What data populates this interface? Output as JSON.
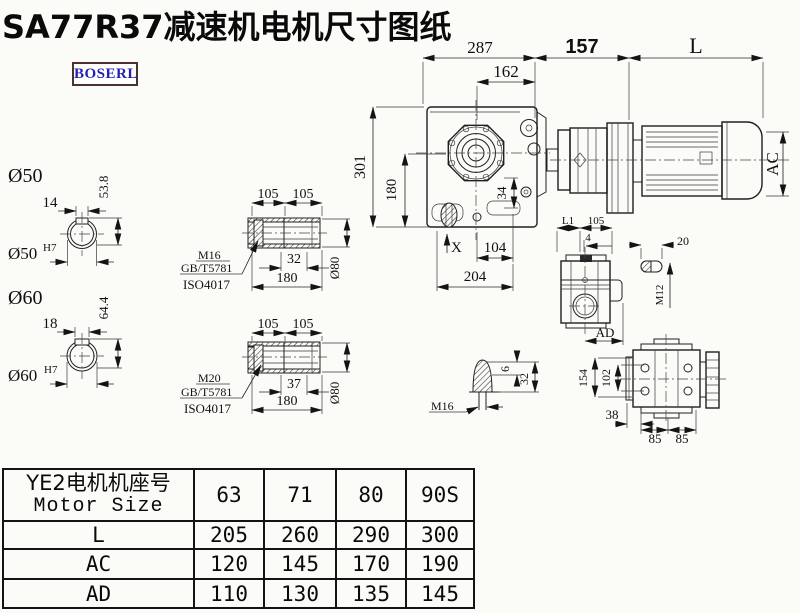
{
  "page": {
    "title": "SA77R37减速机电机尺寸图纸",
    "brand": "BOSERL"
  },
  "colors": {
    "background": "#fbfbf8",
    "line": "#1f1f1f",
    "brand_text": "#241fb0",
    "brand_border": "#4a3232",
    "table_border": "#141414"
  },
  "main_view": {
    "top_width": "287",
    "flange_width": "162",
    "adapter_length": "157",
    "motor_length": "L",
    "total_height": "301",
    "lower_height": "180",
    "motor_diameter": "AC",
    "offset_34": "34",
    "mark_x": "X",
    "bottom_offset": "104",
    "bottom_width": "204"
  },
  "shaft_detail_50": {
    "label": "Ø50",
    "keyway_width": "14",
    "keyway_depth": "53.8",
    "bore": "Ø50",
    "bore_tol": "H7"
  },
  "shaft_detail_60": {
    "label": "Ø60",
    "keyway_width": "18",
    "keyway_depth": "64.4",
    "bore": "Ø60",
    "bore_tol": "H7"
  },
  "hollow_shaft_1": {
    "len_a": "105",
    "len_b": "105",
    "screw_len": "32",
    "total_len": "180",
    "outer_dia": "Ø80",
    "thread": "M16",
    "standard_1": "GB/T5781",
    "standard_2": "ISO4017"
  },
  "hollow_shaft_2": {
    "len_a": "105",
    "len_b": "105",
    "screw_len": "37",
    "total_len": "180",
    "outer_dia": "Ø80",
    "thread": "M20",
    "standard_1": "GB/T5781",
    "standard_2": "ISO4017"
  },
  "bolt_tip_detail": {
    "thread": "M16",
    "tip_len": "6",
    "length": "32"
  },
  "side_view": {
    "dim_l1": "L1",
    "dim_105": "105",
    "dim_4": "4",
    "dim_ad": "AD"
  },
  "key_detail": {
    "length": "20",
    "thread": "M12"
  },
  "bottom_view": {
    "height": "154",
    "inner_height": "102",
    "offset": "38",
    "pitch_a": "85",
    "pitch_b": "85"
  },
  "table": {
    "header_cn": "YE2电机机座号",
    "header_en": "Motor Size",
    "columns": [
      "63",
      "71",
      "80",
      "90S"
    ],
    "rows": [
      {
        "label": "L",
        "values": [
          "205",
          "260",
          "290",
          "300"
        ]
      },
      {
        "label": "AC",
        "values": [
          "120",
          "145",
          "170",
          "190"
        ]
      },
      {
        "label": "AD",
        "values": [
          "110",
          "130",
          "135",
          "145"
        ]
      }
    ]
  }
}
